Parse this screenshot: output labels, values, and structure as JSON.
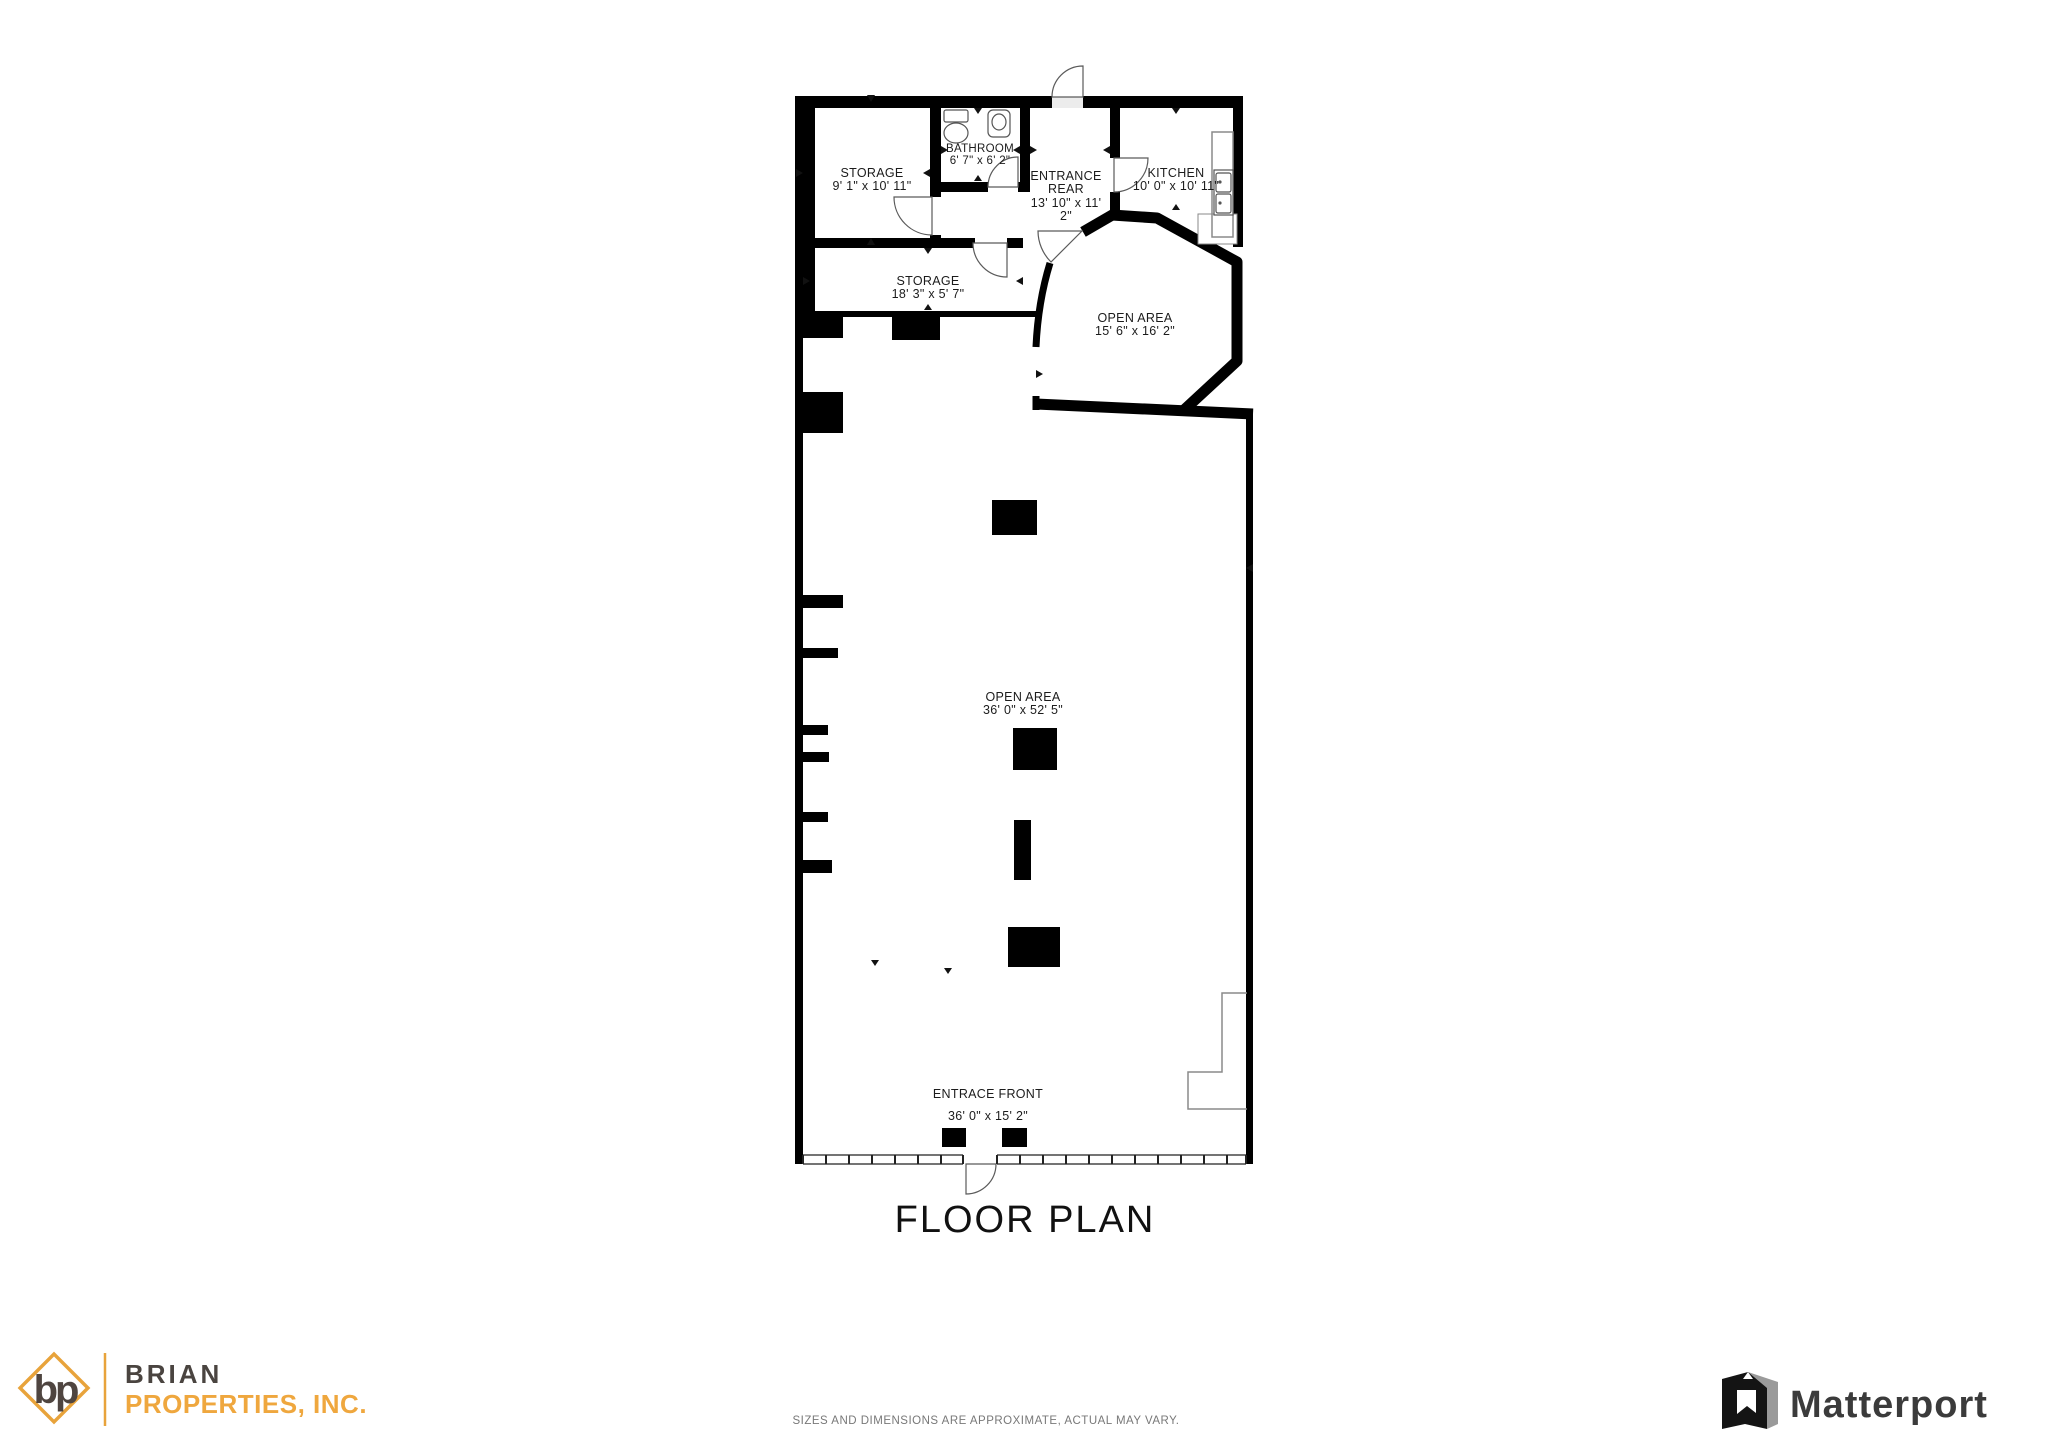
{
  "title": "FLOOR PLAN",
  "disclaimer": "SIZES AND DIMENSIONS ARE APPROXIMATE, ACTUAL MAY VARY.",
  "colors": {
    "wall": "#000000",
    "accent_orange": "#E8A33B",
    "brand_dark": "#4A4440",
    "matterport_dark": "#3B3B3B"
  },
  "rooms": {
    "storage_top": {
      "name": "STORAGE",
      "dims": "9' 1\" x 10' 11\""
    },
    "bathroom": {
      "name": "BATHROOM",
      "dims": "6' 7\" x 6' 2\""
    },
    "entrance_rear": {
      "line1": "ENTRANCE",
      "line2": "REAR",
      "dims1": "13' 10\" x 11'",
      "dims2": "2\""
    },
    "kitchen": {
      "name": "KITCHEN",
      "dims": "10' 0\" x 10' 11\""
    },
    "storage_long": {
      "name": "STORAGE",
      "dims": "18' 3\" x 5' 7\""
    },
    "open_area_small": {
      "name": "OPEN AREA",
      "dims": "15' 6\" x 16' 2\""
    },
    "open_area_large": {
      "name": "OPEN AREA",
      "dims": "36' 0\" x 52' 5\""
    },
    "entrance_front": {
      "name": "ENTRACE FRONT",
      "dims": "36' 0\" x 15' 2\""
    }
  },
  "branding": {
    "broker_monogram": "bp",
    "broker_line1": "BRIAN",
    "broker_line2": "PROPERTIES, INC.",
    "matterport_label": "Matterport"
  }
}
